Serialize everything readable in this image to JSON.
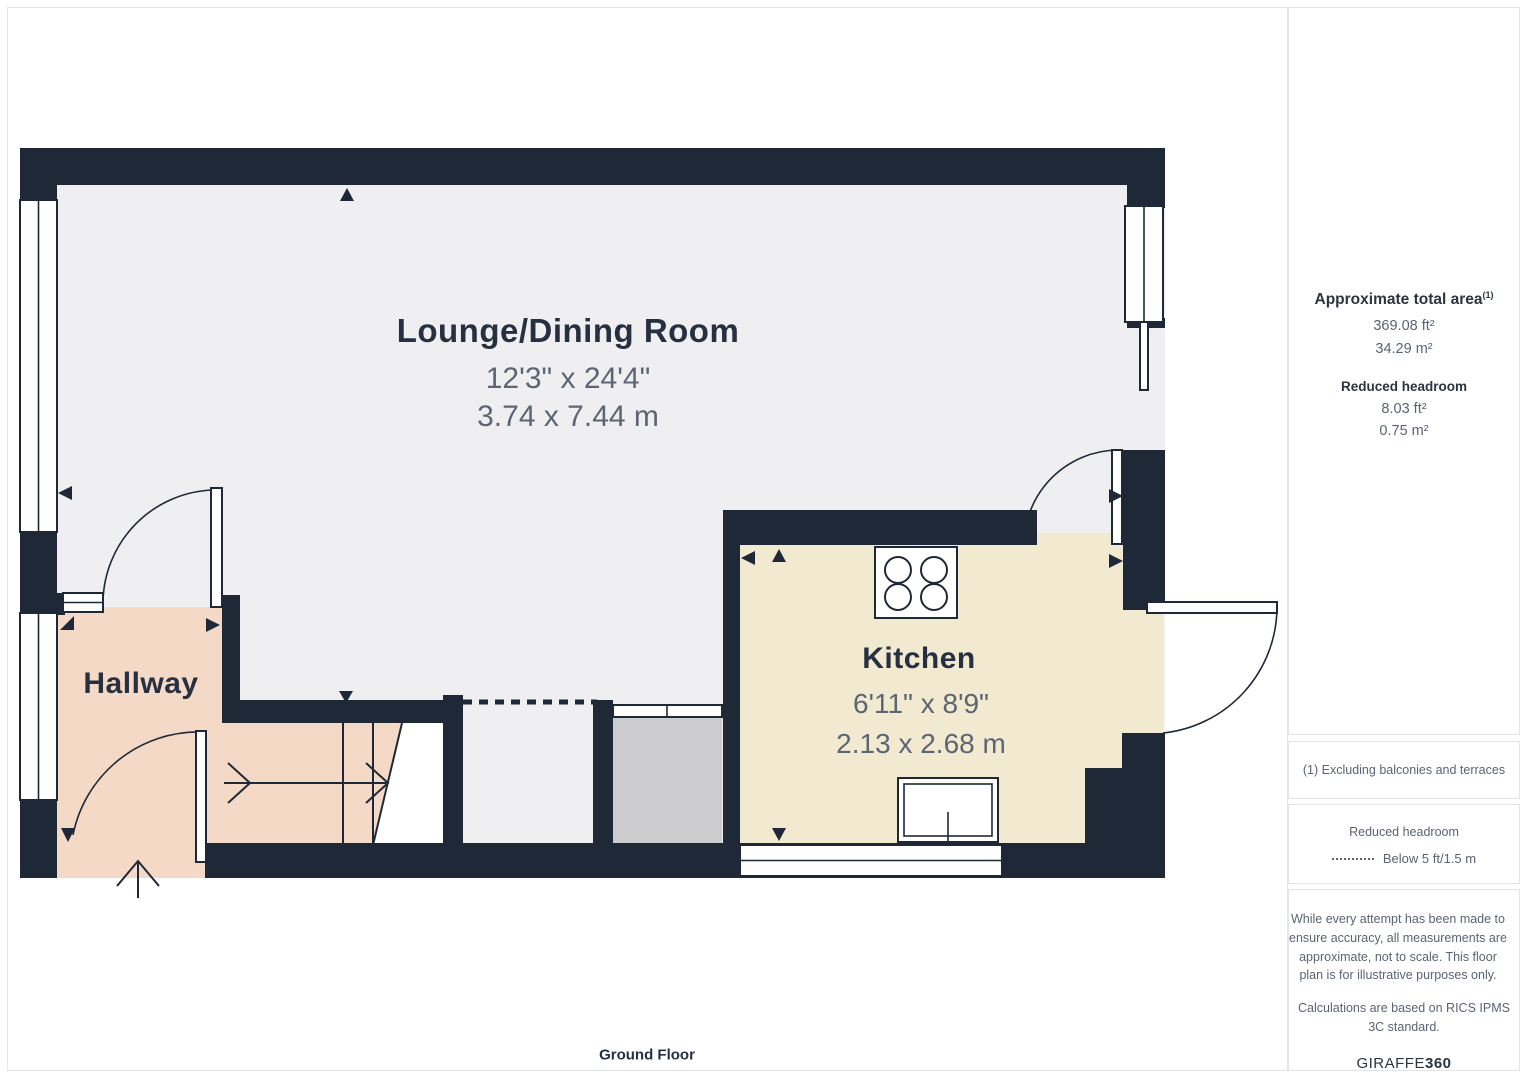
{
  "plan": {
    "rooms": {
      "lounge": {
        "name": "Lounge/Dining Room",
        "imperial": "12'3\" x 24'4\"",
        "metric": "3.74 x 7.44 m"
      },
      "hallway": {
        "name": "Hallway"
      },
      "kitchen": {
        "name": "Kitchen",
        "imperial": "6'11\" x 8'9\"",
        "metric": "2.13 x 2.68 m"
      }
    },
    "floor_label": "Ground Floor"
  },
  "sidebar": {
    "area": {
      "title": "Approximate total area",
      "sup": "(1)",
      "ft": "369.08 ft²",
      "m": "34.29 m²"
    },
    "headroom": {
      "title": "Reduced headroom",
      "ft": "8.03 ft²",
      "m": "0.75 m²"
    },
    "footnote": "(1) Excluding balconies and terraces",
    "legend": {
      "title": "Reduced headroom",
      "label": "Below 5 ft/1.5 m"
    },
    "disclaimer": {
      "p1": "While every attempt has been made to ensure accuracy, all measurements are approximate, not to scale. This floor plan is for illustrative purposes only.",
      "p2": "Calculations are based on RICS IPMS 3C standard."
    },
    "brand": {
      "name": "GIRAFFE",
      "suffix": "360"
    }
  },
  "colors": {
    "wall": "#1e2836",
    "lounge-floor": "#efeff1",
    "hallway-floor": "#f4d9c6",
    "kitchen-floor": "#f2e9d1",
    "closet-floor": "#cccccf",
    "label": "#273040",
    "dim-text": "#5d6573",
    "sidebar-text": "#5b6472",
    "sidebar-heading": "#2b3441",
    "border": "#e4e5e7",
    "bg": "#ffffff"
  }
}
